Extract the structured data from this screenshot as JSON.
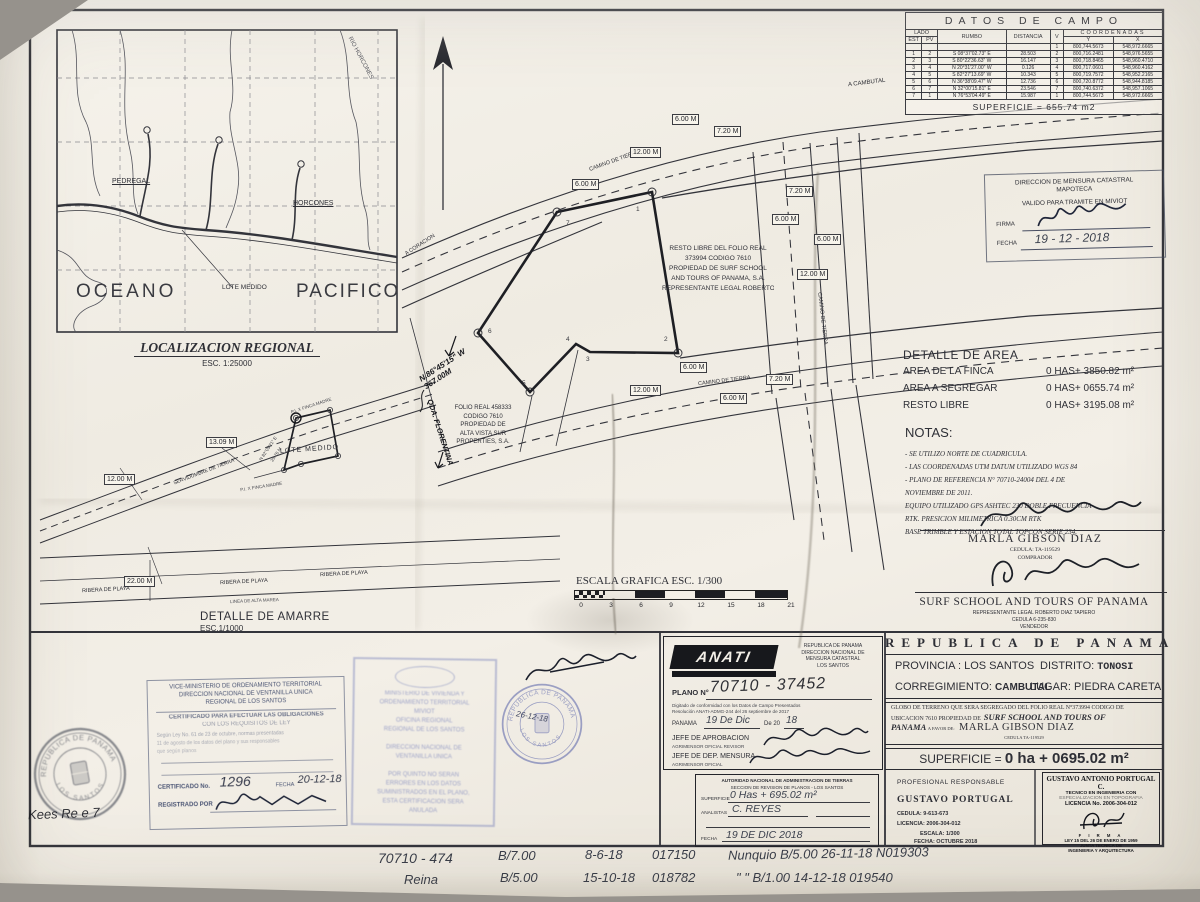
{
  "regional_map": {
    "title": "LOCALIZACION REGIONAL",
    "scale": "ESC. 1:25000",
    "ocean_word1": "OCEANO",
    "ocean_word2": "PACIFICO",
    "pedregal": "PEDREGAL",
    "horcones": "HORCONES",
    "rio_horcones": "RIO HORCONES",
    "lote_medido": "LOTE MEDIDO"
  },
  "plan": {
    "resto_lines": [
      "RESTO LIBRE DEL FOLIO REAL",
      "373994 CODIGO 7610",
      "PROPIEDAD DE SURF SCHOOL",
      "AND TOURS OF PANAMA, S.A.",
      "REPRESENTANTE LEGAL ROBERTO DIAZ TAPIERO"
    ],
    "folio_lines": [
      "FOLIO REAL 458333",
      "CODIGO 7610",
      "PROPIEDAD DE",
      "ALTA VISTA SUR",
      "PROPERTIES, S.A."
    ],
    "a_cambutal": "A CAMBUTAL",
    "a_coracion": "A CORACION",
    "camino1": "CAMINO DE TIERRA",
    "camino2": "CAMINO DE TIERRA",
    "camino3": "CAMINO DE TIERRA",
    "dims": [
      "6.00 M",
      "7.20 M",
      "12.00 M",
      "6.00 M",
      "7.20 M",
      "6.00 M",
      "6.00 M",
      "12.00 M",
      "6.00 M",
      "7.20 M",
      "12.00 M",
      "6.00 M"
    ],
    "vertices": [
      "1",
      "2",
      "3",
      "4",
      "5",
      "6",
      "7"
    ],
    "hw_bearing": "N.86°45'15\" W",
    "hw_dist": "367.00M",
    "qda": "QDA. FLORENTINA"
  },
  "amarre": {
    "caption": "DETALLE DE AMARRE",
    "caption_scale": "ESC.1/1000",
    "lote": "LOTE MEDIDO",
    "servidumbre": "SERVIDUMBRE DE TIERRA",
    "ribera": "RIBERA DE PLAYA",
    "linea": "LINEA DE ALTA MAREA",
    "bearing": "N 82°05'21\" E",
    "seg1": "25.76 M",
    "pi": "P.I. X FINCA MADRE",
    "dims": [
      "13.09 M",
      "12.00 M",
      "22.00 M"
    ]
  },
  "datos": {
    "title": "DATOS DE CAMPO",
    "h_lado": "LADO",
    "h_est": "EST",
    "h_pv": "PV",
    "h_rumbo": "RUMBO",
    "h_dist": "DISTANCIA",
    "h_v": "V",
    "h_coord": "COORDENADAS",
    "h_y": "Y",
    "h_x": "X",
    "rows": [
      {
        "est": "",
        "pv": "",
        "rumbo": "",
        "dist": "",
        "v": "1",
        "y": "800,744.5673",
        "x": "548,972.6665"
      },
      {
        "est": "1",
        "pv": "2",
        "rumbo": "S 08°37'02.73\" E",
        "dist": "28.503",
        "v": "2",
        "y": "800,716.2481",
        "x": "548,976.5655"
      },
      {
        "est": "2",
        "pv": "3",
        "rumbo": "S 80°22'36.63\" W",
        "dist": "16.147",
        "v": "3",
        "y": "800,718.8465",
        "x": "548,960.4710"
      },
      {
        "est": "3",
        "pv": "4",
        "rumbo": "N 20°31'27.00\" W",
        "dist": "0.126",
        "v": "4",
        "y": "800,717.0601",
        "x": "548,960.4162"
      },
      {
        "est": "4",
        "pv": "5",
        "rumbo": "S 82°27'13.69\" W",
        "dist": "10.343",
        "v": "5",
        "y": "800,719.7572",
        "x": "548,952.2165"
      },
      {
        "est": "5",
        "pv": "6",
        "rumbo": "N 36°38'09.47\" W",
        "dist": "12.736",
        "v": "6",
        "y": "800,720.8772",
        "x": "548,944.8185"
      },
      {
        "est": "6",
        "pv": "7",
        "rumbo": "N 32°00'15.81\" E",
        "dist": "23.546",
        "v": "7",
        "y": "800,740.6372",
        "x": "548,957.1065"
      },
      {
        "est": "7",
        "pv": "1",
        "rumbo": "N 76°53'04.49\" E",
        "dist": "15.987",
        "v": "1",
        "y": "800,744.5673",
        "x": "548,972.6665"
      }
    ],
    "superficie": "SUPERFICIE  =  655.74  m2"
  },
  "mapoteca": {
    "line1": "DIRECCION DE MENSURA CATASTRAL",
    "line2": "MAPOTECA",
    "line3": "VALIDO PARA TRAMITE EN MIVIOT",
    "firma_label": "FIRMA",
    "fecha_label": "FECHA",
    "fecha_value": "19 - 12 - 2018"
  },
  "area": {
    "title": "DETALLE DE AREA",
    "rows": [
      {
        "label": "AREA DE LA FINCA",
        "value": "0 HAS+ 3850.82 m²"
      },
      {
        "label": "AREA A SEGREGAR",
        "value": "0 HAS+ 0655.74 m²"
      },
      {
        "label": "RESTO LIBRE",
        "value": "0 HAS+ 3195.08 m²"
      }
    ]
  },
  "notas": {
    "title": "NOTAS:",
    "items": [
      "- SE UTILIZO NORTE DE CUADRICULA.",
      "- LAS COORDENADAS UTM DATUM UTILIZADO WGS 84",
      "- PLANO DE REFERENCIA N° 70710-24004 DEL 4 DE",
      "NOVIEMBRE DE 2011.",
      "EQUIPO UTILIZADO GPS ASHTEC 230 DOBLE FRECUENCIA",
      "RTK. PRESICION MILIMETRICA 0.30CM RTK",
      "BASE TRIMBLE Y ESTACION TOTAL TOPCON SERIE 234."
    ]
  },
  "firmas": {
    "comprador_nombre": "MARLA GIBSON DIAZ",
    "comprador_cedula": "CEDULA: TA-119529",
    "comprador_rol": "COMPRADOR",
    "vendedor_nombre": "SURF SCHOOL AND TOURS OF PANAMA",
    "vendedor_rep": "REPRESENTANTE LEGAL ROBERTO DIAZ TAPIERO",
    "vendedor_cedula": "CEDULA 6-235-830",
    "vendedor_rol": "VENDEDOR"
  },
  "escala": {
    "title": "ESCALA GRAFICA  ESC. 1/300",
    "ticks": [
      "0",
      "3",
      "6",
      "9",
      "12",
      "15",
      "18",
      "21"
    ]
  },
  "cert": {
    "h1": "VICE-MINISTERIO DE ORDENAMIENTO TERRITORIAL",
    "h2": "DIRECCION NACIONAL DE VENTANILLA UNICA",
    "h3": "REGIONAL DE LOS SANTOS",
    "t1": "CERTIFICADO PARA EFECTUAR LAS OBLIGACIONES",
    "t2": "CON LOS REQUISITOS DE LEY",
    "p1": "Según Ley No. 61 de 23 de octubre, normas presentadas",
    "p2": "11 de agosto de los datos del plano y sus responsables",
    "p3": "que según planos",
    "cert_label": "CERTIFICADO No.",
    "cert_value": "1296",
    "fecha_label": "FECHA",
    "fecha_value": "20-12-18",
    "reg_label": "REGISTRADO POR"
  },
  "seal_ls": {
    "top": "REPUBLICA DE PANAMA",
    "bottom": "LOS SANTOS"
  },
  "stamp_blue": {
    "lines": [
      "MINISTERIO DE VIVIENDA Y",
      "ORDENAMIENTO TERRITORIAL",
      "MIVIOT",
      "OFICINA REGIONAL",
      "REGIONAL DE LOS SANTOS",
      "",
      "DIRECCION NACIONAL DE",
      "VENTANILLA UNICA",
      "",
      "POR QUINTO NO SERAN",
      "ERRORES EN LOS DATOS",
      "SUMINISTRADOS EN EL PLANO,",
      "ESTA CERTIFICACION SERA",
      "ANULADA"
    ]
  },
  "seal_blue": {
    "top": "REPUBLICA DE PANAMA",
    "bottom": "LOS SANTOS",
    "hw_date": "26-12-18"
  },
  "anati": {
    "logo": "ANATI",
    "logo_sub": "AUTORIDAD NACIONAL DE ADMINISTRACION DE TIERRAS",
    "right1": "REPUBLICA DE PANAMA",
    "right2": "DIRECCION NACIONAL DE",
    "right3": "MENSURA CATASTRAL",
    "right4": "LOS SANTOS",
    "plano_label": "PLANO N°",
    "plano_value": "70710 - 37452",
    "small1": "Digitado de conformidad con los Datos de Campo Presentados",
    "small2": "Resolución ANATI-ADMG-244 del 26 septiembre de 2017",
    "panama": "PANAMA",
    "fecha_hw": "19 De Dic",
    "de20": "De 20",
    "anio_hw": "18",
    "jefe1": "JEFE DE APROBACION",
    "jefe1_sub": "AGRIMENSOR OFICIAL REVISOR",
    "jefe2": "JEFE DE DEP. MENSURA",
    "jefe2_sub": "AGRIMENSOR OFICIAL"
  },
  "revision": {
    "l1": "AUTORIDAD NACIONAL DE ADMINISTRACION DE TIERRAS",
    "l2": "SECCION DE REVISION DE PLANOS - LOS SANTOS",
    "sup_label": "SUPERFICIE",
    "sup_value": "0 Has + 695.02 m²",
    "ana_label": "ANALISTAS",
    "ana_value": "C. REYES",
    "fecha_label": "FECHA",
    "fecha_value": "19 DE DIC 2018"
  },
  "cuadro": {
    "pais": "REPUBLICA DE PANAMA",
    "prov_label": "PROVINCIA :",
    "prov": "LOS SANTOS",
    "dist_label": "DISTRITO:",
    "dist": "TONOSI",
    "corr_label": "CORREGIMIENTO:",
    "corr": "CAMBUTAL",
    "lugar_label": "LUGAR:",
    "lugar": "PIEDRA CARETA",
    "globo1": "GLOBO DE TERRENO QUE SERA SEGREGADO DEL FOLIO REAL N°373994  CODIGO DE",
    "globo2": "UBICACION 7610 PROPIEDAD DE",
    "globo2b": "SURF SCHOOL AND TOURS OF",
    "globo3b": "PANAMA",
    "globo3": "A FAVOR DE:",
    "favor_nombre": "MARLA GIBSON DIAZ",
    "favor_cedula": "CEDULA TA-119529",
    "sup_label": "SUPERFICIE  =",
    "sup_value": "0 ha + 0695.02 m²",
    "prof_label": "PROFESIONAL RESPONSABLE",
    "prof_nombre": "GUSTAVO PORTUGAL",
    "prof_cedula": "CEDULA: 9-613-673",
    "prof_lic": "LICENCIA: 2006-304-012",
    "prof_esc": "ESCALA: 1/300",
    "prof_fecha": "FECHA: OCTUBRE 2018",
    "sello": [
      "GUSTAVO ANTONIO PORTUGAL C.",
      "TECNICO EN INGENIERIA CON",
      "ESPECIALIZACION EN TOPOGRAFIA",
      "LICENCIA No. 2006-304-012",
      "F I R M A",
      "LEY 15 DEL 26 DE ENERO DE 1959",
      "JUNTA TECNICA DE",
      "INGENIERIA Y ARQUITECTURA"
    ]
  },
  "hw_bottom": {
    "r1c1": "70710 - 474",
    "r1c2": "B/7.00",
    "r1c3": "8-6-18",
    "r1c4": "017150",
    "r1c5": "Nunquio B/5.00   26-11-18   N019303",
    "r2c1": "Reina",
    "r2c2": "B/5.00",
    "r2c3": "15-10-18",
    "r2c4": "018782",
    "r2c5": "\"  \"  B/1.00    14-12-18   019540",
    "scribble": "Kees  Re e    7"
  }
}
